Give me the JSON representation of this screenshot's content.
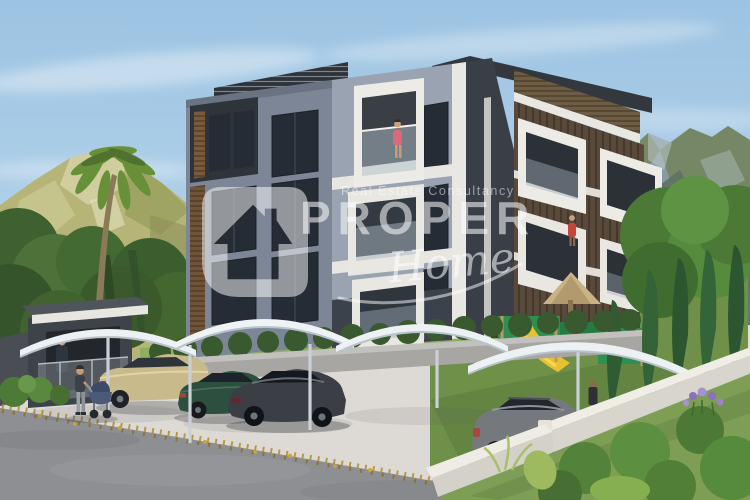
{
  "meta": {
    "type": "3d-architectural-render",
    "subject": "Modern four-storey apartment complex with covered parking, playground, garden walls and mountain backdrop",
    "canvas": {
      "width": 750,
      "height": 500
    }
  },
  "watermark": {
    "tagline": "Real Estate Consultancy",
    "brand": "PROPER",
    "script": "Home",
    "icon": "house-logo",
    "color": "#ffffff",
    "opacity": 0.52
  },
  "scene": {
    "sky": {
      "top": "#9cc3e2",
      "bottom": "#d6e7f2",
      "clouds": "wispy white streaks"
    },
    "mountains": {
      "left_hill": "#b6b577",
      "right_range": "#8a9aa4",
      "right_green": "#75875c"
    },
    "building": {
      "storeys": 4,
      "left_face_color": "#7d8696",
      "center_face_color": "#9aa3b2",
      "right_face_color": "#58493a",
      "balcony_color": "#edebe6",
      "window_color": "#262c35",
      "wood_accent_color": "#7a5a3c",
      "parapet_color": "#2e333a",
      "people_on_balconies": 2
    },
    "ground": {
      "pavement": "#e0ded9",
      "road": "#8d8f92",
      "retaining_wall": "#a7a6a2",
      "garden_wall": "#f0ede6",
      "grass": "#7e9d55",
      "fallen_leaves": "#b08c2e"
    },
    "parking": {
      "canopy_count": 4,
      "canopy_color": "#eef1f4",
      "cars": [
        {
          "name": "beige-sedan",
          "color": "#c9ba8c"
        },
        {
          "name": "green-sedan",
          "color": "#2c4f40"
        },
        {
          "name": "charcoal-coupe",
          "color": "#3b3f45"
        },
        {
          "name": "gray-suv",
          "color": "#75787d"
        }
      ]
    },
    "playground": {
      "slide": "#e8c22e",
      "panels": "#2f8f52",
      "gazebo_roof": "#c9b286"
    },
    "figures": [
      "woman-with-stroller",
      "security-guard-in-kiosk",
      "balcony-woman-pink",
      "balcony-figure-red",
      "person-near-playground"
    ],
    "vegetation": [
      "palm-tree",
      "left-tree-cluster",
      "cypress-row",
      "large-right-tree",
      "foreground-bushes",
      "purple-flowers"
    ]
  }
}
